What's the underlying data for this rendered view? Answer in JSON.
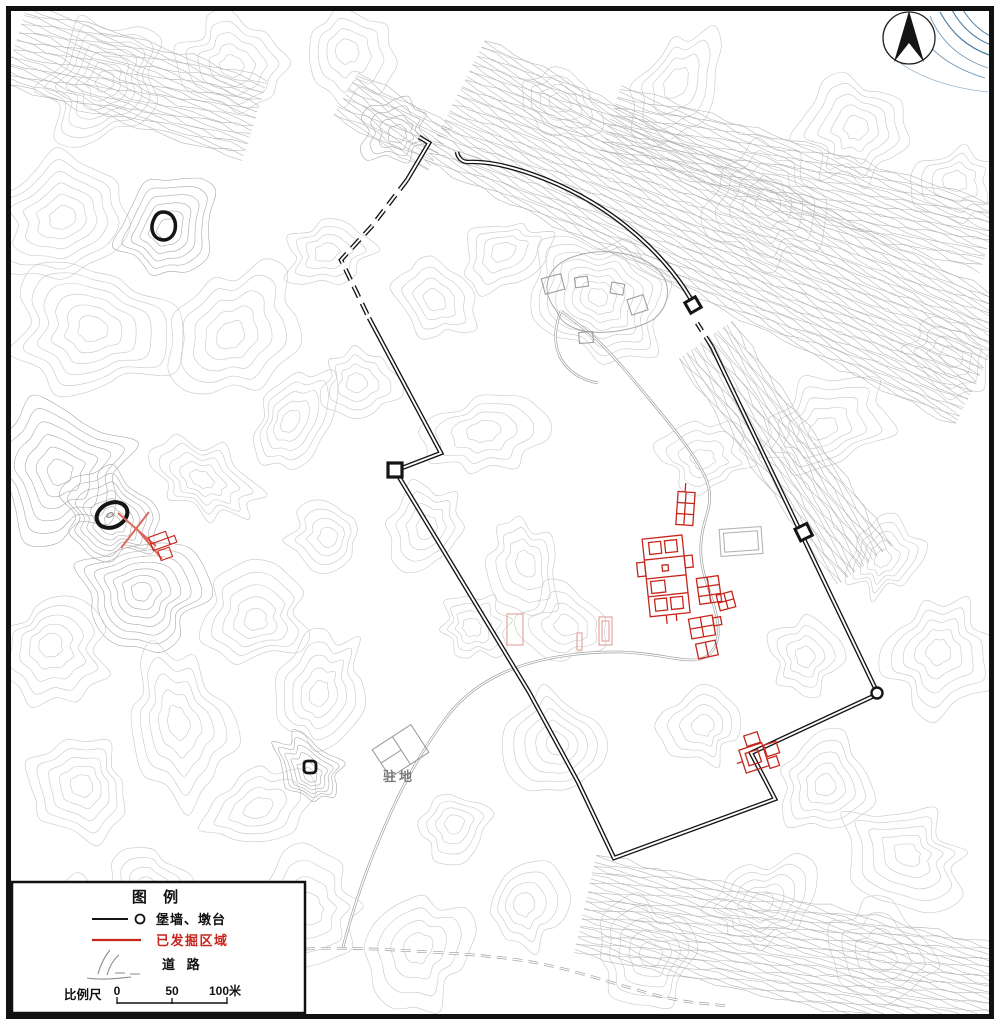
{
  "figure": {
    "kind": "archaeological-site-topographic-map",
    "north_indicator": "north-arrow"
  },
  "map_labels": {
    "camp": "驻地"
  },
  "legend": {
    "title": "图  例",
    "items": [
      {
        "label": "堡墙、墩台",
        "symbol": "wall-line-and-circle",
        "color": "#151515"
      },
      {
        "label": "已发掘区域",
        "symbol": "red-line",
        "color": "#c6261c"
      },
      {
        "label": "道  路",
        "symbol": "road-sketch",
        "color": "#8a8a8a"
      }
    ],
    "scale_label": "比例尺",
    "scale_ticks": {
      "t0": "0",
      "t50": "50",
      "t100": "100米"
    }
  },
  "colors": {
    "wall": "#151515",
    "excavated": "#c6261c",
    "excavated_faint": "#e2a89f",
    "contour": "#c7c7c7",
    "contour_dark": "#a9a9a9",
    "road": "#9b9b9b",
    "water": "#4d7fa6",
    "structure_gray": "#9e9e9e"
  }
}
